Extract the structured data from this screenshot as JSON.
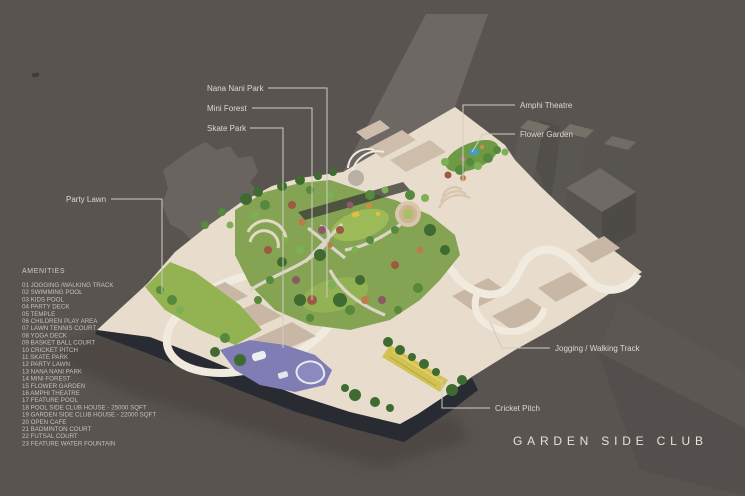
{
  "page": {
    "title": "GARDEN SIDE CLUB"
  },
  "callouts": {
    "nana_nani_park": "Nana Nani Park",
    "mini_forest": "Mini Forest",
    "skate_park": "Skate Park",
    "party_lawn": "Party Lawn",
    "amphi_theatre": "Amphi Theatre",
    "flower_garden": "Flower Garden",
    "jogging_track": "Jogging / Walking Track",
    "cricket_pitch": "Cricket Pitch"
  },
  "amenities": {
    "title": "AMENITIES",
    "items": [
      "01 JOGGING /WALKING TRACK",
      "02 SWIMMING POOL",
      "03 KIDS POOL",
      "04 PARTY DECK",
      "05 TEMPLE",
      "06 CHILDREN PLAY AREA",
      "07 LAWN TENNIS COURT",
      "08 YOGA DECK",
      "09 BASKET BALL COURT",
      "10 CRICKET PITCH",
      "11 SKATE PARK",
      "12 PARTY LAWN",
      "13 NANA NANI PARK",
      "14 MINI FOREST",
      "15 FLOWER GARDEN",
      "16 AMPHI THEATRE",
      "17 FEATURE POOL",
      "18 POOL SIDE CLUB HOUSE - 25000 SQFT",
      "19 GARDEN SIDE CLUB HOUSE - 22000 SQFT",
      "20 OPEN CAFE",
      "21 BADMINTON COURT",
      "22 FUTSAL COURT",
      "23 FEATURE WATER FOUNTAIN"
    ]
  },
  "colors": {
    "background": "#595450",
    "label_text": "#dcd8d2",
    "title_text": "#e5e1db",
    "plaza_cream": "#e8ddcd",
    "garden_green": "#84a454",
    "skate_purple": "#7f7db4",
    "cricket_yellow": "#d2c253",
    "podium_dark": "#282c32"
  }
}
